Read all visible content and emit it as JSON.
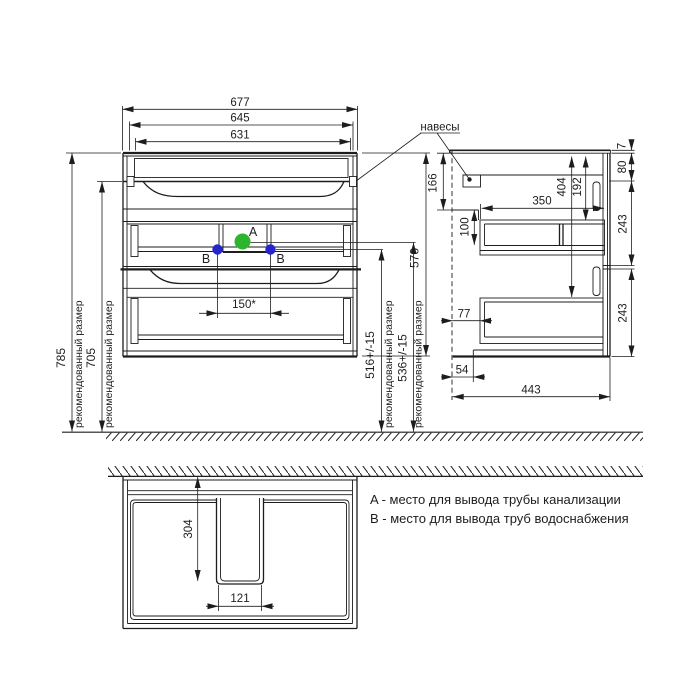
{
  "colors": {
    "ink": "#1d1d1d",
    "drain_point_a": "#2db52d",
    "water_point_b": "#2525cd"
  },
  "annotations": {
    "hangers_label": "навесы",
    "recommended_size": "рекомендованный размер",
    "point_a": "A",
    "point_b": "B"
  },
  "legend": {
    "line_a": "A - место для вывода трубы канализации",
    "line_b": "B - место для вывода труб водоснабжения"
  },
  "front_view": {
    "dims": {
      "width_total": "677",
      "width_mid": "645",
      "width_inner": "631",
      "height_total": "785",
      "height_under_top": "705",
      "cabinet_height": "570",
      "drain_height": "536+/-15",
      "water_height": "516+/-15",
      "b_spacing": "150*"
    }
  },
  "side_view": {
    "dims": {
      "hanger_drop": "166",
      "niche_height": "100",
      "shelf_depth": "350",
      "inner_height": "404",
      "top_clearance": "192",
      "top_thickness": "7",
      "apron_height": "80",
      "drawer_top": "243",
      "drawer_bottom": "243",
      "back_gap": "77",
      "bottom_step": "54",
      "depth_total": "443"
    }
  },
  "bottom_view": {
    "dims": {
      "cutout_depth": "304",
      "cutout_width": "121"
    }
  }
}
